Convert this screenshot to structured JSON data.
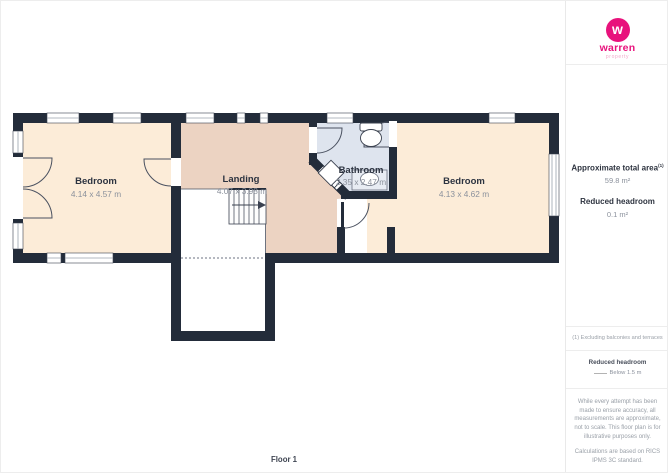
{
  "logo": {
    "brand": "warren",
    "sub": "property",
    "mark_letter": "w"
  },
  "sidebar": {
    "approx_area_label": "Approximate total area",
    "approx_area_sup": "(1)",
    "approx_area_value": "59.8 m²",
    "reduced_headroom_label": "Reduced headroom",
    "reduced_headroom_value": "0.1 m²",
    "footnote": "(1) Excluding balconies and terraces",
    "legend_title": "Reduced headroom",
    "legend_item": "Below 1.5 m",
    "disclaimer1": "While every attempt has been made to ensure accuracy, all measurements are approximate, not to scale. This floor plan is for illustrative purposes only.",
    "disclaimer2": "Calculations are based on RICS IPMS 3C standard.",
    "brand_footer_name": "GIRAFFE",
    "brand_footer_number": "360"
  },
  "floorplan": {
    "floor_label": "Floor 1",
    "rooms": [
      {
        "name": "Bedroom",
        "dims": "4.14 x 4.57 m"
      },
      {
        "name": "Landing",
        "dims": "4.07 x 3.98 m"
      },
      {
        "name": "Bathroom",
        "dims": "2.35 x 2.47 m"
      },
      {
        "name": "Bedroom",
        "dims": "4.13 x 4.62 m"
      }
    ],
    "colors": {
      "wall": "#232c3a",
      "bedroom_fill": "#fcecd8",
      "landing_fill": "#ecd3c2",
      "bathroom_fill": "#dee4ee",
      "accent": "#e8127c"
    }
  }
}
